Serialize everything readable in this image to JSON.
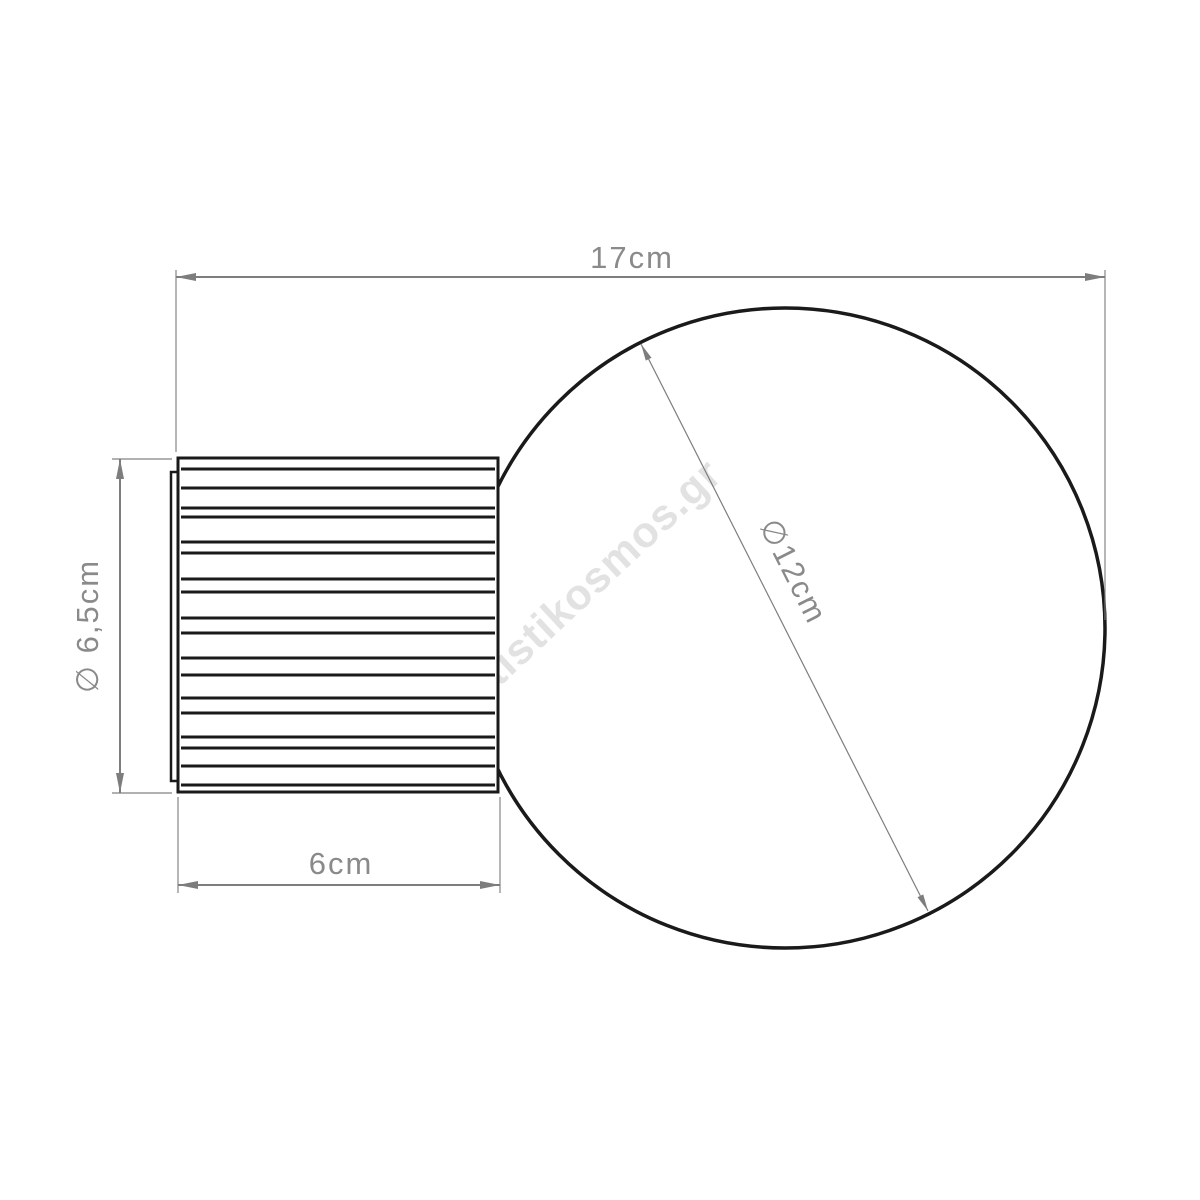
{
  "page": {
    "background": "#ffffff"
  },
  "watermark": {
    "text": "fotistikosmos.gr",
    "color": "#e2e2e2"
  },
  "drawing": {
    "type": "technical-dimension-diagram",
    "subject": "globe-bulb-with-ribbed-wall-base",
    "outline_color": "#1a1a1a"
  },
  "dimension_style": {
    "line_color": "#7d7d7d",
    "text_color": "#8a8a8a"
  },
  "dimensions": {
    "total_width": {
      "label": "17cm",
      "value_cm": 17
    },
    "base_width": {
      "label": "6cm",
      "value_cm": 6
    },
    "base_diameter": {
      "label": "∅ 6,5cm",
      "value_cm": 6.5
    },
    "globe_diameter": {
      "label": "∅12cm",
      "value_cm": 12
    }
  }
}
